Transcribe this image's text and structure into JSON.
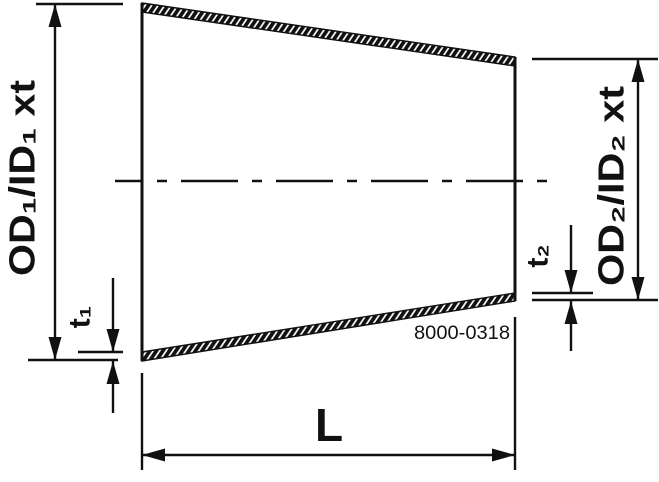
{
  "drawing": {
    "title": "concentric-reducer-dimension-drawing",
    "labels": {
      "od1": "OD₁/ID₁ xt",
      "od2": "OD₂/ID₂ xt",
      "t1": "t₁",
      "t2": "t₂",
      "length": "L",
      "part_number": "8000-0318"
    },
    "colors": {
      "line": "#111111",
      "background": "#ffffff"
    }
  }
}
